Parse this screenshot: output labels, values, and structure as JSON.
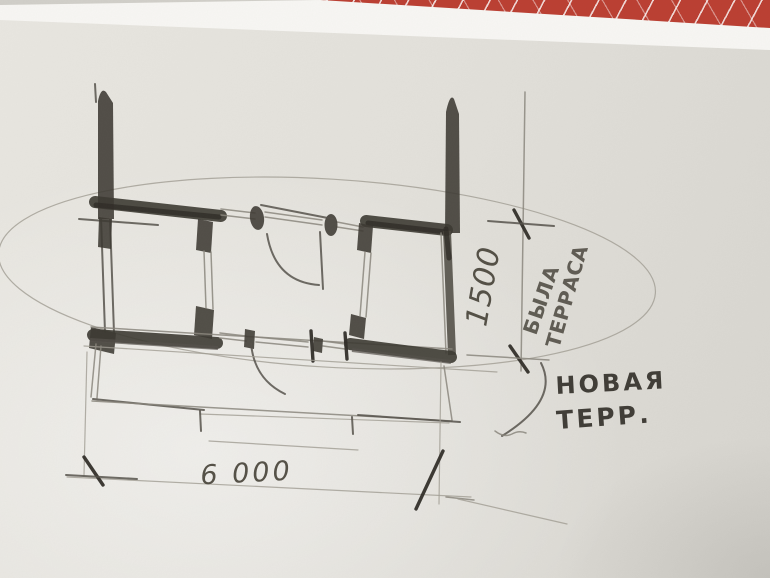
{
  "labels": {
    "width_dimension": "6 000",
    "depth_dimension": "1500",
    "old_terrace": {
      "line1": "БЫЛА",
      "line2": "ТЕРРАСА"
    },
    "new_terrace": {
      "line1": "НОВАЯ",
      "line2": "ТЕРР."
    }
  },
  "colors": {
    "tablecloth_red": "#bc3e31",
    "paper": "#e4e2dc",
    "paper_edge": "#f8f7f4",
    "pencil_dark": "#3b3831",
    "pencil_light": "#8b877e"
  }
}
